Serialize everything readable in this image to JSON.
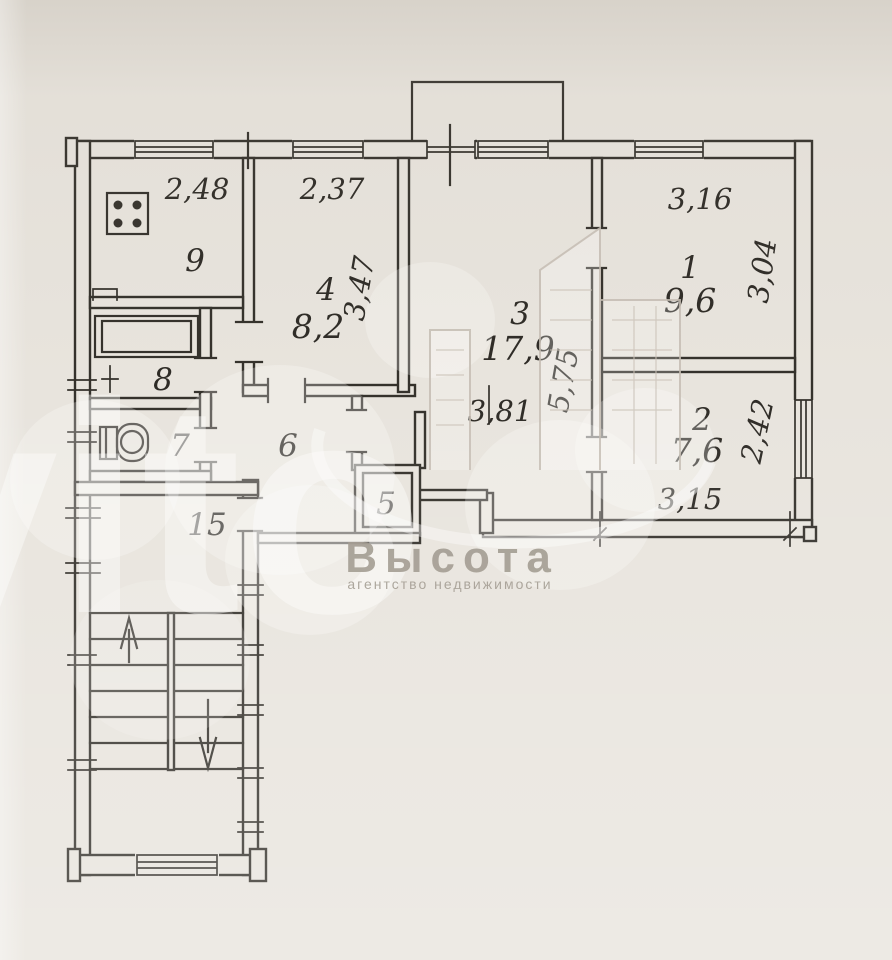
{
  "floor_plan": {
    "rooms": [
      {
        "number": "1",
        "area": "9,6"
      },
      {
        "number": "2",
        "area": "7,6"
      },
      {
        "number": "3",
        "area": "17,9"
      },
      {
        "number": "4",
        "area": "8,2"
      },
      {
        "number": "5"
      },
      {
        "number": "6"
      },
      {
        "number": "7"
      },
      {
        "number": "8"
      },
      {
        "number": "9"
      },
      {
        "number": "15"
      }
    ],
    "dimensions": {
      "kitchen_width": "2,48",
      "room4_width": "2,37",
      "room4_depth": "3,47",
      "room1_width": "3,16",
      "room1_depth": "3,04",
      "room3_width": "3,81",
      "room3_depth": "5,75",
      "room2_depth": "2,42",
      "room2_width": "3,15"
    },
    "watermark": {
      "brand": "Avito",
      "agency_name": "Высота",
      "agency_subtitle": "агентство недвижимости"
    }
  }
}
